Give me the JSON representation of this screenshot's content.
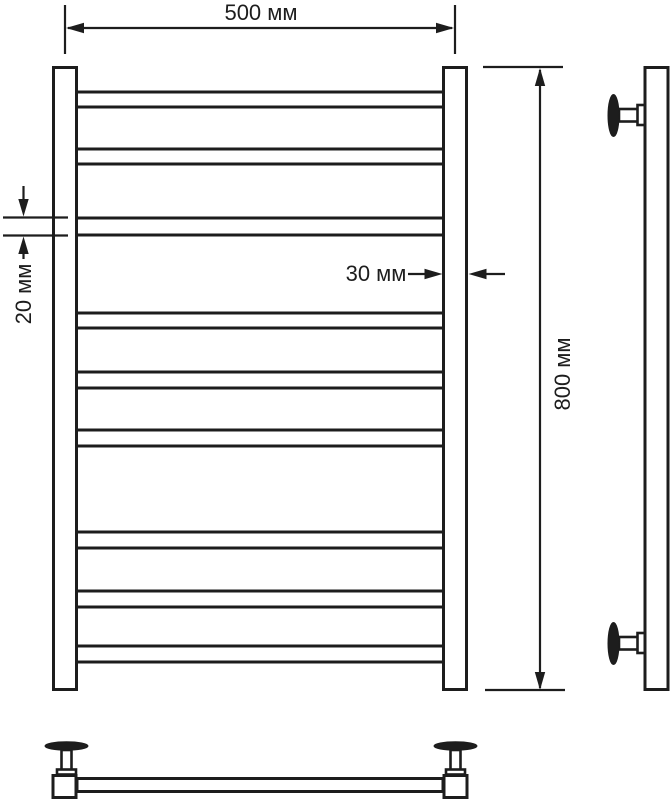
{
  "diagram": {
    "labels": {
      "overall_width": "500 мм",
      "overall_height": "800 мм",
      "tube_diameter": "20 мм",
      "post_width": "30 мм"
    },
    "front_view": {
      "rung_count": 9,
      "rung_span_x": [
        72,
        448
      ],
      "rungs_y": [
        [
          92,
          107
        ],
        [
          149,
          164
        ],
        [
          218,
          235
        ],
        [
          313,
          328
        ],
        [
          372,
          388
        ],
        [
          430,
          446
        ],
        [
          532,
          548
        ],
        [
          591,
          607
        ],
        [
          646,
          662
        ]
      ]
    },
    "colors": {
      "line": "#1d1d1d",
      "background": "#ffffff"
    }
  }
}
